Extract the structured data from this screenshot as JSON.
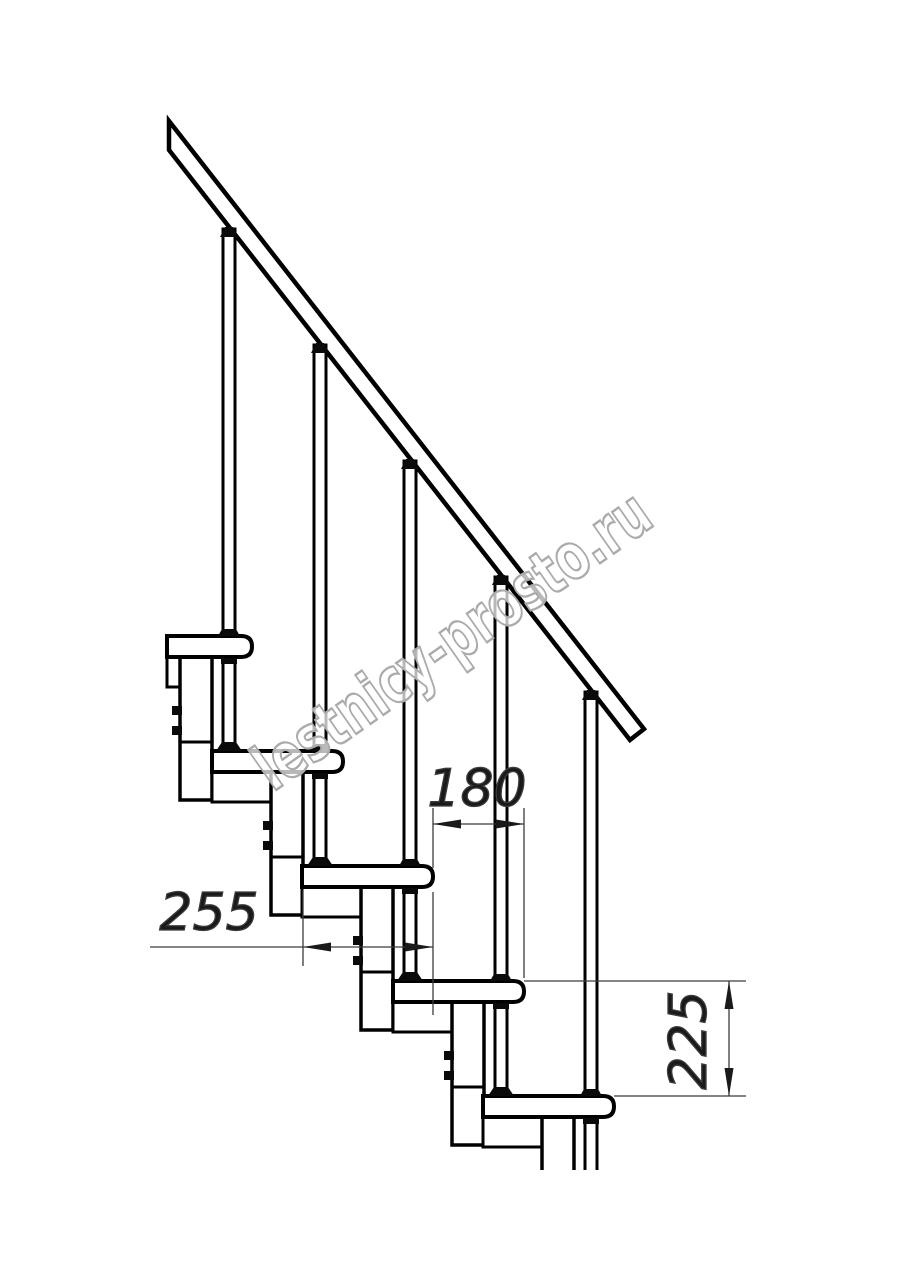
{
  "drawing": {
    "type": "modular-staircase-side-view",
    "background": "#ffffff",
    "line_color": "#000000",
    "dim_line_color": "#3c3c3c",
    "steps_visible": 5
  },
  "dimensions": {
    "run": {
      "label": "180",
      "meaning": "step run between tread noses"
    },
    "depth": {
      "label": "255",
      "meaning": "tread depth"
    },
    "rise": {
      "label": "225",
      "meaning": "riser height between treads"
    }
  },
  "watermark": {
    "text": "lestnicy-prosto.ru",
    "color": "#ababab"
  }
}
